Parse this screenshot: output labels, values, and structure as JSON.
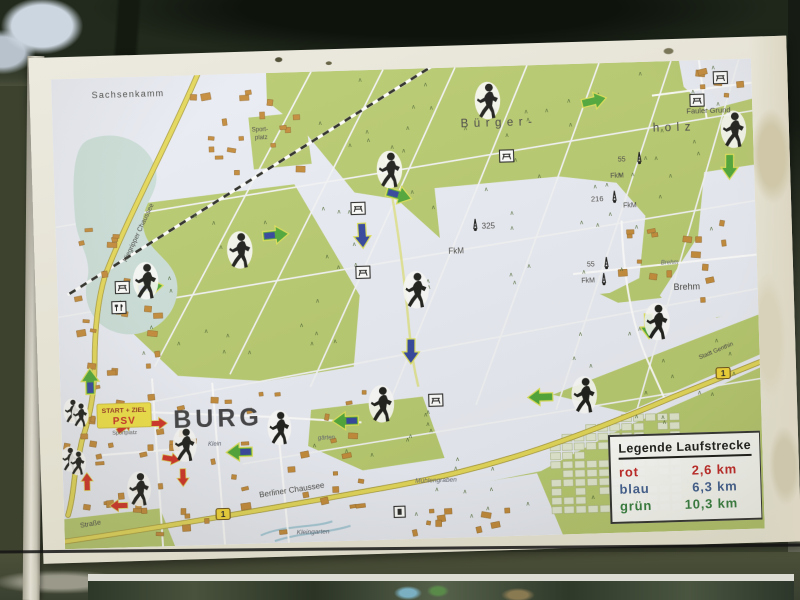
{
  "scene": {
    "description": "Outdoor information board photo: running route map of Burg with Bürgerholz forest"
  },
  "legend": {
    "title": "Legende Laufstrecke",
    "routes": [
      {
        "name": "rot",
        "distance": "2,6 km",
        "color": "#c32020"
      },
      {
        "name": "blau",
        "distance": "6,3 km",
        "color": "#3d5c91"
      },
      {
        "name": "grün",
        "distance": "10,3 km",
        "color": "#2f7c3a"
      }
    ]
  },
  "map": {
    "labels": {
      "sachsenkamm": "Sachsenkamm",
      "buerger": "Bürger-",
      "holz": "holz",
      "fauler_grund": "Fauler Grund",
      "brehm": "Brehm",
      "brehm_road": "Brehm",
      "burg": "BURG",
      "start_ziel": "START + ZIEL",
      "psv": "PSV",
      "sportplatz_start": "Sportplatz",
      "sportplatz_line1": "Sport-",
      "sportplatz_line2": "platz",
      "berliner_chaussee": "Berliner Chaussee",
      "strasse": "Straße",
      "niegripper_chaussee": "Niegripper Chaussee",
      "muehlengraben": "Mühlengraben",
      "kleingarten": "Kleingarten",
      "klein_italic": "Klein",
      "gaerten_italic": "gärten",
      "stadt_genthin": "Stadt Genthin",
      "route_number": "1",
      "elev_325": "325",
      "elev_216": "216",
      "elev_55a": "55",
      "elev_55b": "55",
      "fkm": "FkM"
    },
    "icons": {
      "runner": "runner-icon (black running figure silhouette)",
      "picnic": "picnic-table-icon (rest area)",
      "restaurant": "restaurant-icon (fork and knife)",
      "tower": "survey-tower-icon (FkM marker)",
      "info": "info-icon",
      "route_shield": "route-1-shield (Bundesstraße 1)"
    },
    "colors": {
      "forest": "#b6c968",
      "water": "#c9ded8",
      "road_major": "#e6d84f",
      "building": "#c5872f",
      "route_red": "#d6281c",
      "route_blue": "#2b3f9f",
      "route_green": "#46a52e",
      "board": "#e6e3d6"
    }
  }
}
